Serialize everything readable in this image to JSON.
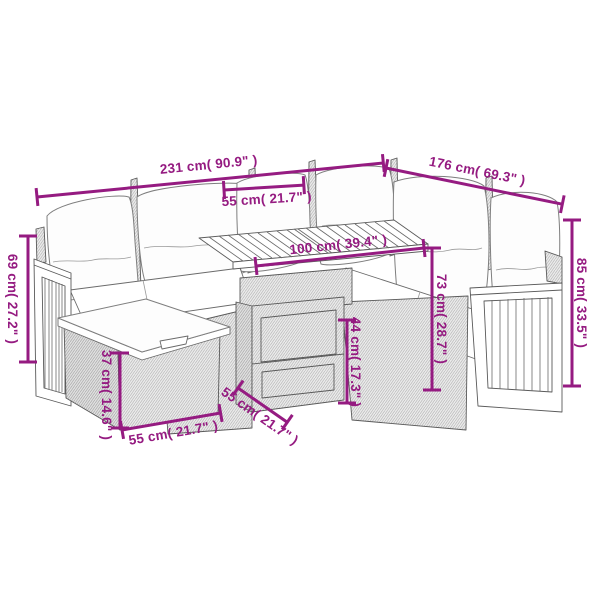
{
  "figure": {
    "kind": "product-dimension-diagram",
    "subject": "garden-lounge-set-line-drawing",
    "background_color": "#ffffff",
    "dimension_color": "#951B81"
  },
  "dims": {
    "d231": {
      "label": "231 cm( 90.9\" )",
      "meaning": "left sofa total length"
    },
    "d176": {
      "label": "176 cm( 69.3\" )",
      "meaning": "right sofa total length"
    },
    "d55_seat": {
      "label": "55 cm( 21.7\" )",
      "meaning": "seat width"
    },
    "d100": {
      "label": "100 cm( 39.4\" )",
      "meaning": "table length"
    },
    "d69": {
      "label": "69 cm( 27.2\" )",
      "meaning": "left arm height"
    },
    "d37": {
      "label": "37 cm( 14.6\" )",
      "meaning": "footstool height"
    },
    "d55_ottoman": {
      "label": "55 cm( 21.7\" )",
      "meaning": "footstool width"
    },
    "d55_table": {
      "label": "55 cm( 21.7\" )",
      "meaning": "table depth"
    },
    "d44": {
      "label": "44 cm( 17.3\" )",
      "meaning": "table height"
    },
    "d73": {
      "label": "73 cm( 28.7\" )",
      "meaning": "backrest height"
    },
    "d85": {
      "label": "85 cm( 33.5\" )",
      "meaning": "total height"
    }
  }
}
